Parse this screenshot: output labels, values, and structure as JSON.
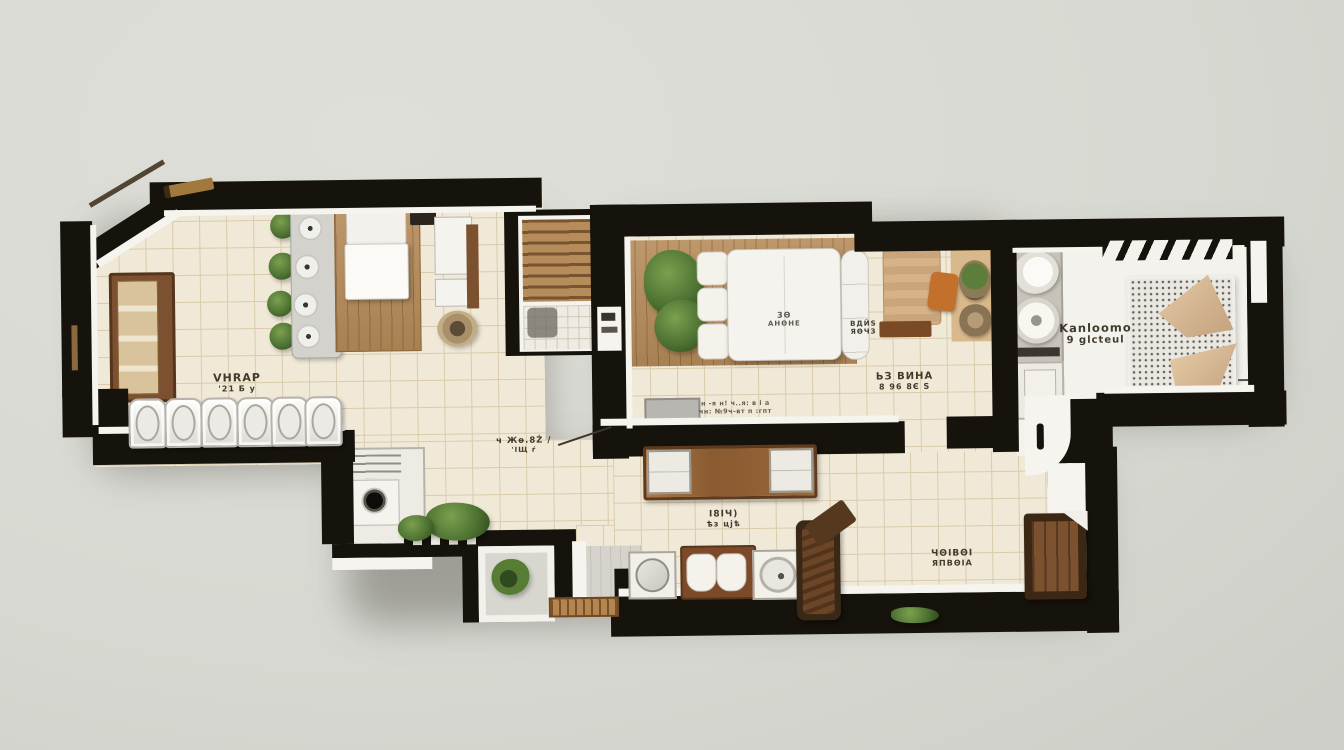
{
  "palette": {
    "background": "#d8d9d2",
    "wall": "#16120c",
    "tile_floor": "#f1e9d8",
    "tile_line": "#d9cbab",
    "wood_floor": "#b68c5a",
    "white_trim": "#f5f4ee",
    "furniture_wood": "#7c5130",
    "tan": "#d7b289",
    "accent_orange": "#c2702c",
    "plant_green": "#4f7433",
    "grey_fixture": "#c7c3bb",
    "label_ink": "#2b2215"
  },
  "labels": {
    "living": [
      "VHRAP",
      "'21 Б у"
    ],
    "hall": [
      "ч Жѳ.8Ż /",
      "'ІЩ ŕ"
    ],
    "master_sofa": [
      "3Θ",
      "АНΘНЕ"
    ],
    "master_waits": [
      "ВДЙЅ",
      "ЯѲЧЗ"
    ],
    "master_lavina": [
      "ЬЗ ВИНА",
      "8 96 8Є Ѕ"
    ],
    "master_note": [
      "н -я н! ч..я: в і а",
      "чн: №9ч-вт п :гпт"
    ],
    "dining": [
      "І8ІЧ)",
      "ѣз цјѣ"
    ],
    "bottom_right": [
      "ЧΘΙΒΘΙ",
      "ЯПВΘΙА"
    ],
    "bath_bedroom": [
      "Kanloomo",
      "9 glcteul"
    ]
  }
}
